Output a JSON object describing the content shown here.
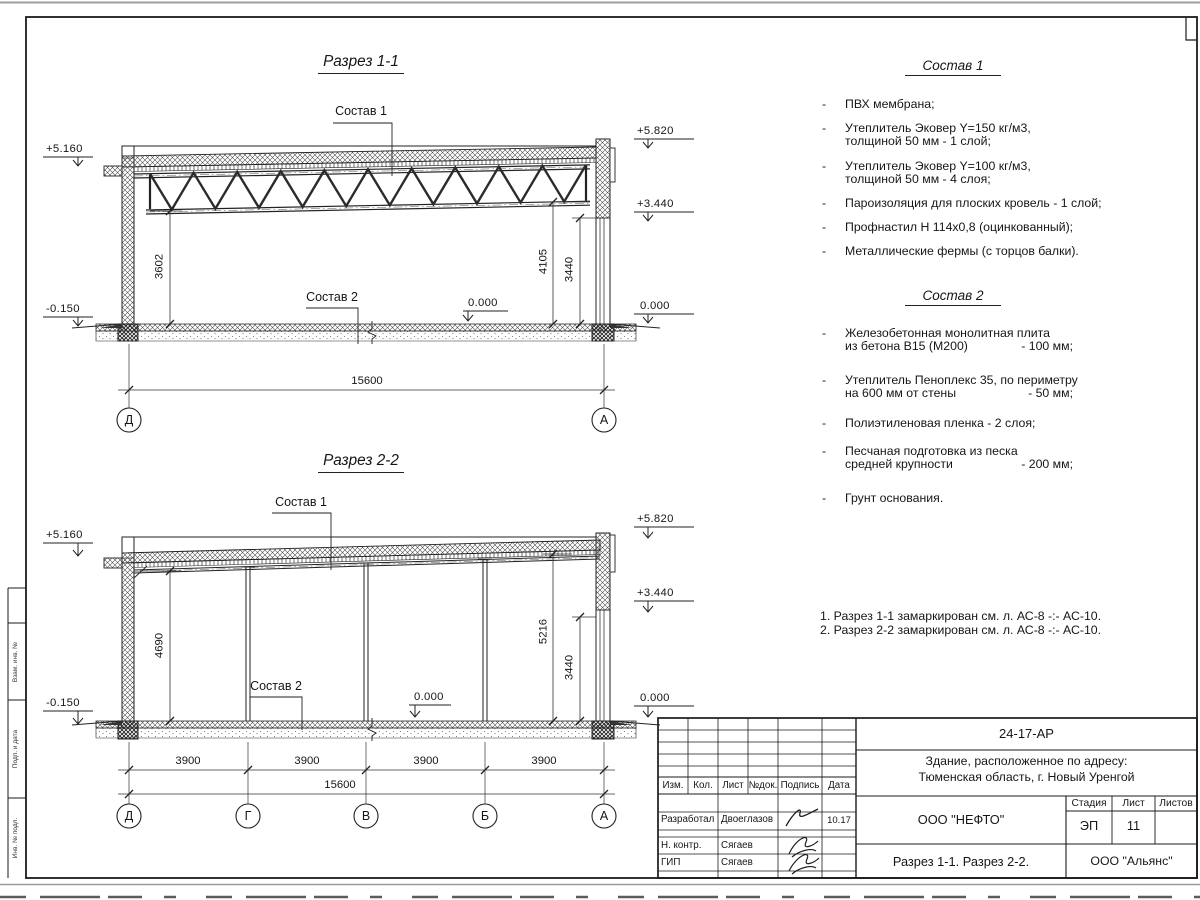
{
  "s1": {
    "title": "Разрез 1-1",
    "sostav1_label": "Состав 1",
    "sostav2_label": "Состав 2",
    "lvl_5160": "+5.160",
    "lvl_5820": "+5.820",
    "lvl_3440": "+3.440",
    "lvl_0_right": "0.000",
    "lvl_0_floor": "0.000",
    "lvl_m0150": "-0.150",
    "dim_3602": "3602",
    "dim_4105": "4105",
    "dim_3440": "3440",
    "dim_15600": "15600",
    "axes": [
      "Д",
      "А"
    ]
  },
  "s2": {
    "title": "Разрез 2-2",
    "sostav1_label": "Состав 1",
    "sostav2_label": "Состав 2",
    "lvl_5160": "+5.160",
    "lvl_5820": "+5.820",
    "lvl_3440": "+3.440",
    "lvl_0_right": "0.000",
    "lvl_0_floor": "0.000",
    "lvl_m0150": "-0.150",
    "dim_4690": "4690",
    "dim_5216": "5216",
    "dim_3440": "3440",
    "dim_15600": "15600",
    "dims_3900": [
      "3900",
      "3900",
      "3900",
      "3900"
    ],
    "axes": [
      "Д",
      "Г",
      "В",
      "Б",
      "А"
    ]
  },
  "sostav1": {
    "heading": "Состав 1",
    "items": [
      {
        "line1": "ПВХ мембрана;",
        "line2": ""
      },
      {
        "line1": "Утеплитель Эковер Y=150 кг/м3,",
        "line2": "толщиной 50 мм - 1 слой;"
      },
      {
        "line1": "Утеплитель Эковер Y=100 кг/м3,",
        "line2": "толщиной 50 мм - 4 слоя;"
      },
      {
        "line1": "Пароизоляция для плоских кровель - 1 слой;",
        "line2": ""
      },
      {
        "line1": "Профнастил Н 114х0,8 (оцинкованный);",
        "line2": ""
      },
      {
        "line1": "Металлические фермы (с торцов балки).",
        "line2": ""
      }
    ]
  },
  "sostav2": {
    "heading": "Состав 2",
    "items": [
      {
        "line1": "Железобетонная  монолитная плита",
        "line2": "из бетона В15 (М200)",
        "value": "- 100 мм;"
      },
      {
        "line1": "Утеплитель Пеноплекс 35, по периметру",
        "line2": "на 600 мм от стены",
        "value": "- 50 мм;"
      },
      {
        "line1": "Полиэтиленовая пленка - 2 слоя;",
        "line2": "",
        "value": ""
      },
      {
        "line1": "Песчаная подготовка из песка",
        "line2": "средней крупности",
        "value": "- 200 мм;"
      },
      {
        "line1": "Грунт основания.",
        "line2": "",
        "value": ""
      }
    ]
  },
  "notes": {
    "line1": "1. Разрез 1-1 замаркирован см. л. АС-8 -:- АС-10.",
    "line2": "2. Разрез 2-2 замаркирован см. л. АС-8 -:- АС-10."
  },
  "titleblock": {
    "doc_number": "24-17-АР",
    "object_line1": "Здание, расположенное по адресу:",
    "object_line2": "Тюменская область, г. Новый Уренгой",
    "company": "ООО \"НЕФТО\"",
    "stage_label": "Стадия",
    "sheet_label": "Лист",
    "sheets_label": "Листов",
    "stage": "ЭП",
    "sheet": "11",
    "sheets": "",
    "sheet_title": "Разрез 1-1. Разрез 2-2.",
    "contractor": "ООО \"Альянс\"",
    "col_izm": "Изм.",
    "col_kol": "Кол.",
    "col_list": "Лист",
    "col_ndok": "№док.",
    "col_podpis": "Подпись",
    "col_data": "Дата",
    "row1_role": "Разработал",
    "row1_name": "Двоеглазов",
    "row1_date": "10.17",
    "row2_role": "Н. контр.",
    "row2_name": "Сягаев",
    "row3_role": "ГИП",
    "row3_name": "Сягаев"
  },
  "left_margin": {
    "labels": [
      "Взам. инв. №",
      "Подп. и дата",
      "Инв. № подл."
    ]
  }
}
